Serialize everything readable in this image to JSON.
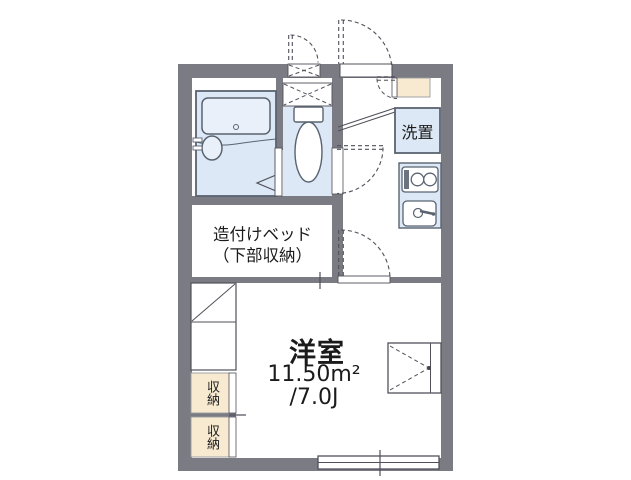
{
  "plan": {
    "type": "japanese-apartment-floor-plan",
    "colors": {
      "wall": "#7b7b84",
      "room_fill": "#dce8f5",
      "fixture_fill": "#e9f0f9",
      "storage_fill": "#f7ead1",
      "line": "#50505a",
      "text": "#1b1b1b",
      "background": "#ffffff"
    },
    "labels": {
      "built_in_bed_line1": "造付けベッド",
      "built_in_bed_line2": "（下部収納）",
      "main_room_name": "洋室",
      "main_room_area_m2": "11.50m²",
      "main_room_area_tatami": "/7.0J",
      "washer_place": "洗置",
      "storage_upper": "収納",
      "storage_lower": "収納"
    },
    "fixtures": [
      "bathtub",
      "bath-sink",
      "folding-bath-door",
      "toilet",
      "overhead-cabinet",
      "meter-box",
      "entry-door",
      "shoe-cabinet",
      "genkan-step",
      "washing-machine-space",
      "gas-stove",
      "kitchen-sink",
      "toilet-door",
      "room-door",
      "built-in-bed",
      "desk-steps",
      "storage-closet-upper",
      "storage-closet-lower",
      "casement-window",
      "sliding-window"
    ]
  }
}
